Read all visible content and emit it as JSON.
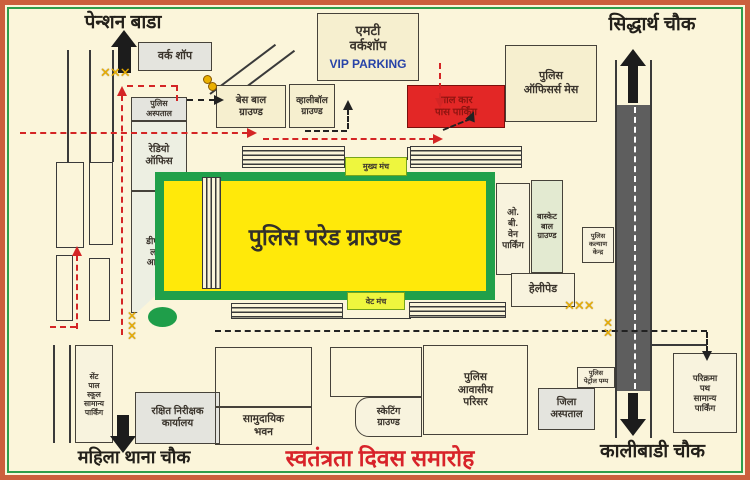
{
  "event_title": "स्वतंत्रता दिवस समारोह",
  "landmarks": {
    "pension_bada": "पेन्शन बाडा",
    "siddharth_chowk": "सिद्धार्थ चौक",
    "mahila_thana_chowk": "महिला थाना चौक",
    "kalibadi_chowk": "कालीबाडी चौक"
  },
  "parade_ground": {
    "label": "पुलिस परेड ग्राउण्ड",
    "fill": "#ffe90a",
    "border": "#21a04a"
  },
  "stages": {
    "main_stage": "मुख्य मंच",
    "vet_stage": "वेट मंच"
  },
  "buildings": {
    "work_shop": "वर्क शॉप",
    "mt_workshop": "एमटी\nवर्कशॉप",
    "vip_parking": "VIP PARKING",
    "base_ball_ground": "बेस बाल\nग्राउण्ड",
    "volleyball_ground": "व्हालीबॉल\nग्राउण्ड",
    "red_car_pass_parking": "लाल कार\nपास पार्किंग",
    "police_officers_mess": "पुलिस\nऑफिसर्स मेस",
    "police_hospital": "पुलिस\nअस्पताल",
    "radio_office": "रेडियो\nऑफिस",
    "dsp_line_office": "डीएसपी\nलाईन\nआफिस",
    "ob_van_parking": "ओ.\nबी.\nवेन\nपार्किंग",
    "basket_ball_ground": "बास्केट\nबाल\nग्राउण्ड",
    "police_welfare_center": "पुलिस\nकल्याण\nकेन्द्र",
    "helipad": "हेलीपेड",
    "st_paul_parking": "सेंट\nपाल\nस्कूल\nसामान्य\nपार्किंग",
    "rakshit_inspector_office": "रक्षित निरीक्षक\nकार्यालय",
    "community_hall": "सामुदायिक\nभवन",
    "skating_ground": "स्केटिंग\nग्राउण्ड",
    "police_residential": "पुलिस\nआवासीय\nपरिसर",
    "police_petrol_pump": "पुलिस\nपेट्रोल पम्प",
    "district_hospital": "जिला\nअस्पताल",
    "parikrama_parking": "परिक्रमा\nपथ\nसामान्य\nपार्किंग"
  },
  "icons": {
    "crossing_h": "✕✕✕",
    "crossing_v2": "✕\n✕",
    "crossing_v3": "✕\n✕\n✕"
  },
  "colors": {
    "accent_red": "#d8232a",
    "vip_blue": "#2743a8",
    "crossing_yellow": "#eab000",
    "road_gray": "#5e5e5e",
    "map_green": "#21a04a"
  }
}
